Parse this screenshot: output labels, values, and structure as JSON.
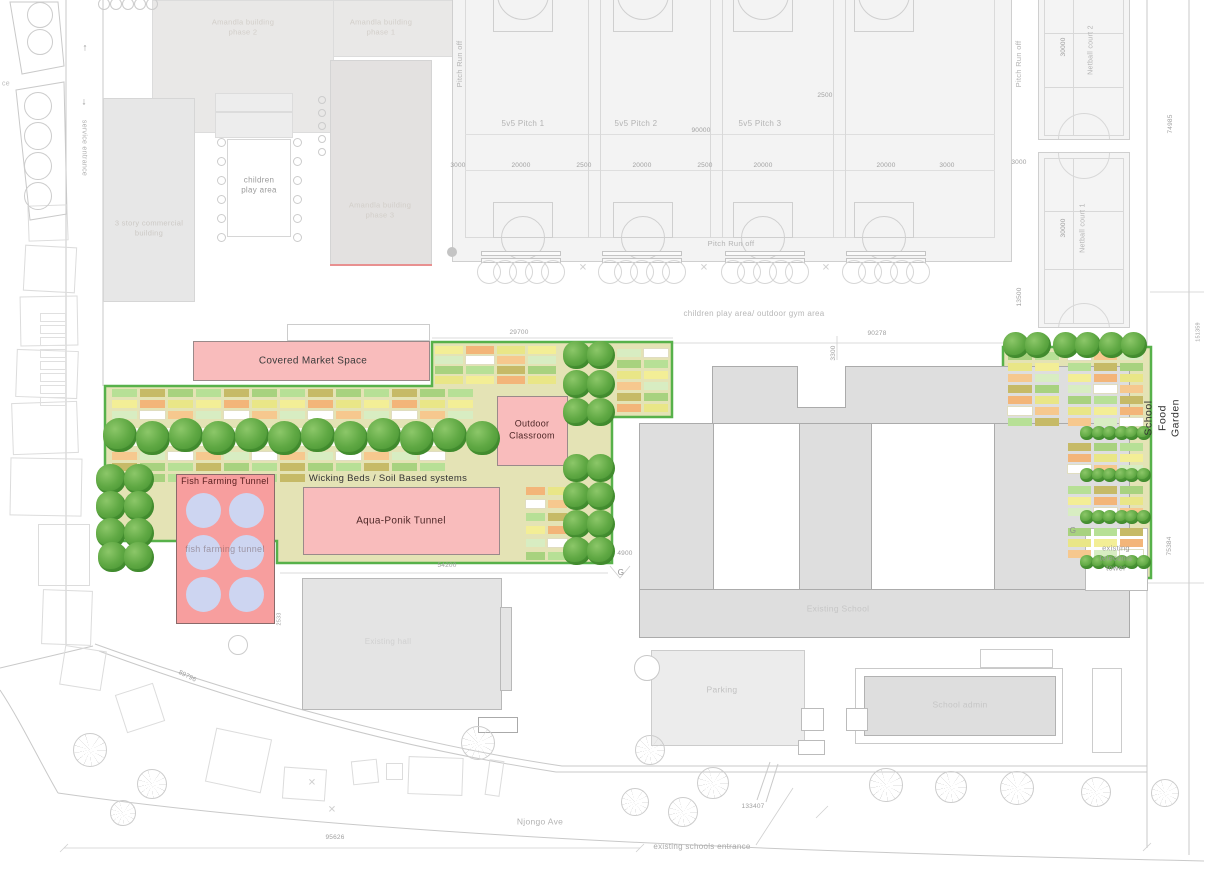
{
  "labels": {
    "amandla_phase2": "Amandla building\nphase 2",
    "amandla_phase1": "Amandla building\nphase 1",
    "amandla_phase3": "Amandla building\nphase 3",
    "commercial": "3 story commercial\nbuilding",
    "children_play": "children\nplay area",
    "service_entrance": "service entrance",
    "edge_fragment": "ce",
    "arrow_up": "↑",
    "arrow_down": "↓",
    "pitch_run_off": "Pitch Run off",
    "pitch1": "5v5 Pitch 1",
    "pitch2": "5v5 Pitch 2",
    "pitch3": "5v5 Pitch 3",
    "netball1": "Netball court 1",
    "netball2": "Netball court 2",
    "play_gym": "children play area/ outdoor gym area",
    "covered_market": "Covered Market Space",
    "outdoor_classroom": "Outdoor\nClassroom",
    "wicking": "Wicking Beds / Soil Based systems",
    "aqua": "Aqua-Ponik Tunnel",
    "fish_title": "Fish Farming Tunnel",
    "fish_faint": "fish farming tunnel",
    "urban_ag": "Urban agriculture",
    "school_food_garden": "School Food Garden",
    "telecoms": "existing\ntelecoms\ntower",
    "existing_school": "Existing School",
    "existing_hall": "Existing hall",
    "parking": "Parking",
    "school_admin": "School admin",
    "njongo": "Njongo Ave",
    "schools_entrance": "existing schools entrance",
    "gate": "G"
  },
  "dims": {
    "d3000": "3000",
    "d20000": "20000",
    "d2500": "2500",
    "d90000": "90000",
    "d30000": "30000",
    "d13500": "13500",
    "d29700": "29700",
    "d90278": "90278",
    "d3300": "3300",
    "d74985": "74985",
    "d151359": "151359",
    "d75384": "75384",
    "d54200": "54200",
    "d4900": "4900",
    "d2533": "2533",
    "d133407": "133407",
    "d95626": "95626",
    "d89796": "89796"
  },
  "colors": {
    "garden_fill": "#e4e3b5",
    "garden_border": "#57b14a",
    "pink_fill": "#f9bcbc",
    "fish_fill": "#f79e9e",
    "tank_fill": "#cdd5f1",
    "school_fill": "#dedede",
    "field_fill": "#f3f3f3",
    "beds": [
      "#b7e096",
      "#f6c88e",
      "#f3ee96",
      "#c6ba67",
      "#d8edc2",
      "#f3b579",
      "#a8d27f",
      "#ffffff",
      "#e9e687"
    ]
  }
}
